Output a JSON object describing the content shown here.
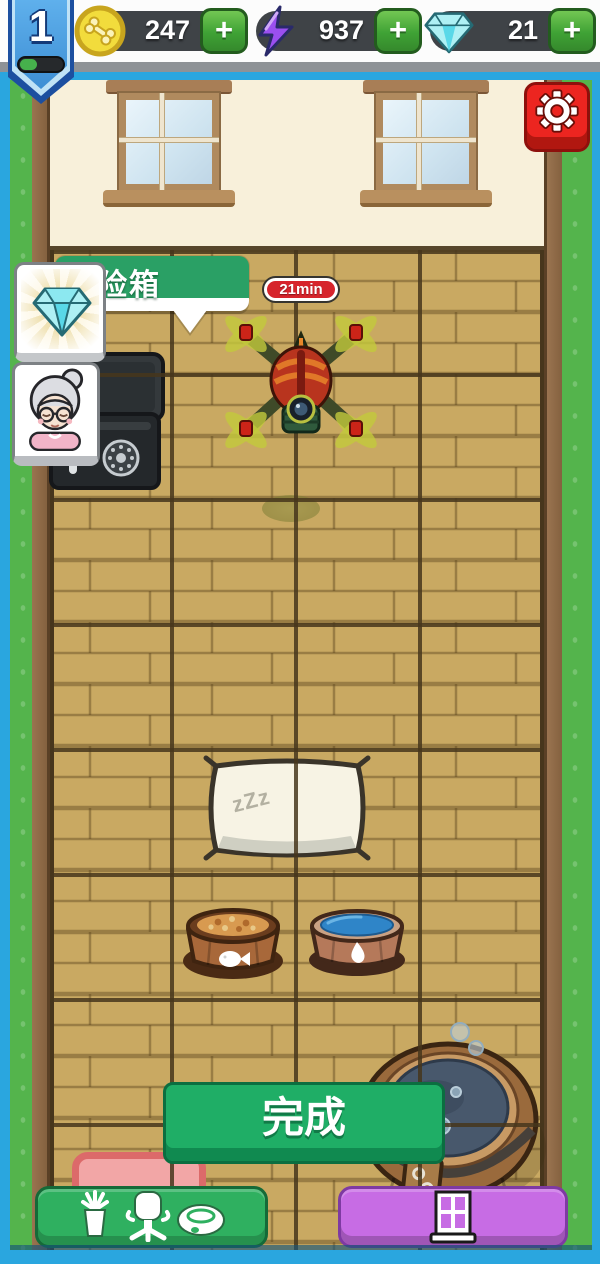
{
  "header": {
    "level_badge": {
      "level": "1",
      "progress_percent": 38
    },
    "currencies": [
      {
        "id": "coins",
        "icon": "bone-coin-icon",
        "value": "247",
        "add_label": "+"
      },
      {
        "id": "energy",
        "icon": "lightning-icon",
        "value": "937",
        "add_label": "+"
      },
      {
        "id": "gems",
        "icon": "gem-icon",
        "value": "21",
        "add_label": "+"
      }
    ],
    "settings": {
      "icon": "gear-icon"
    }
  },
  "scene": {
    "tooltip": {
      "label": "保险箱",
      "reward_icon": "gem-icon"
    },
    "npc": {
      "icon": "grandma-avatar"
    },
    "timer_badge": {
      "label": "21min"
    },
    "pillow": {
      "sleep_text": "zZz"
    },
    "objects": [
      "safe",
      "drone",
      "pillow",
      "food-bowl",
      "water-bowl",
      "bath-tub",
      "pink-mat"
    ]
  },
  "footer": {
    "complete_button": {
      "label": "完成"
    },
    "furniture_button": {
      "icons": [
        "plant-icon",
        "chair-icon",
        "pet-bowl-icon"
      ]
    },
    "wallpaper_button": {
      "icon": "window-icon"
    }
  },
  "colors": {
    "frame_blue": "#2aa6df",
    "grass_green": "#54b44c",
    "floor_tan": "#c9a962",
    "banner_green": "#2aa065",
    "button_green": "#1fae66",
    "button_purple": "#c76ce4",
    "timer_red": "#d6242c",
    "settings_red": "#ec2520",
    "pill_dark": "#3f4347"
  }
}
